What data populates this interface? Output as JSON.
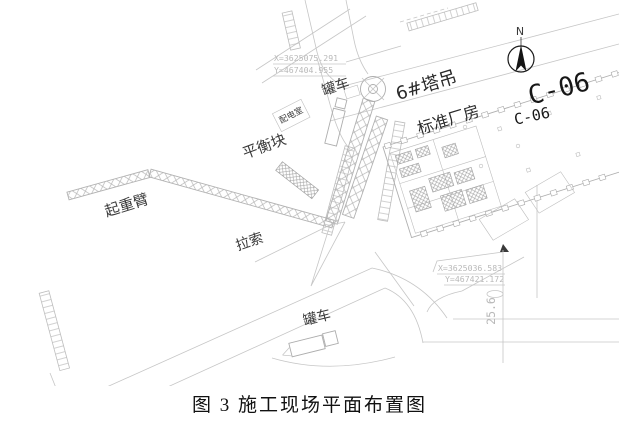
{
  "caption": "图 3 施工现场平面布置图",
  "plan": {
    "north": "N",
    "tower_crane_label": "6#塔吊",
    "factory_label": "标准厂房",
    "building_code_large": "C-06",
    "building_code_small": "C-06",
    "crane_boom_label": "起重臂",
    "guy_cable_label": "拉索",
    "counterweight_label": "平衡块",
    "power_room_label": "配电室",
    "tanker_truck_top_label": "罐车",
    "tanker_truck_bottom_label": "罐车",
    "dimension_label": "25.6",
    "survey_point_top": {
      "x_line": "X=3625075.291",
      "y_line": "Y=467404.955"
    },
    "survey_point_right": {
      "x_line": "X=3625036.583",
      "y_line": "Y=467421.172"
    },
    "colors": {
      "cad_line": "#c6c6c6",
      "truss_line": "#b2b2b2",
      "label_dark": "#3a3a3a",
      "label_light": "#b9b9b9",
      "north_arrow": "#141414",
      "background": "#ffffff"
    }
  }
}
